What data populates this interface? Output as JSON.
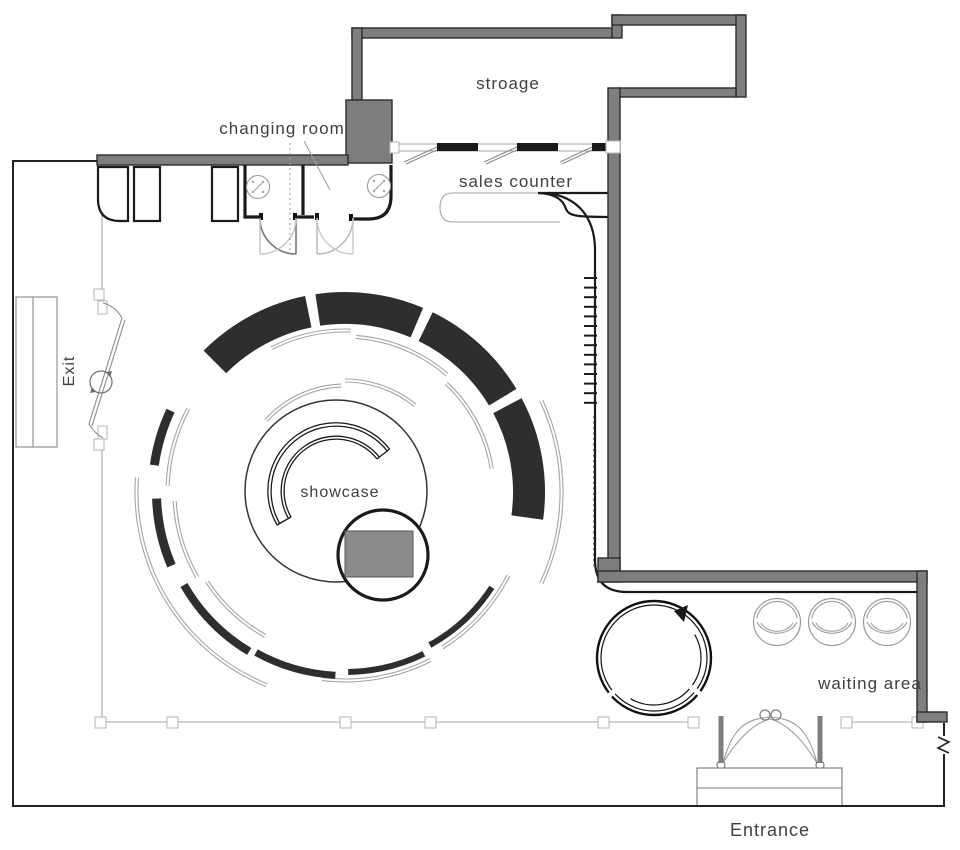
{
  "title": "boutique retail store floor plan",
  "labels": {
    "storage": "stroage",
    "changing_room": "changing room",
    "sales_counter": "sales counter",
    "showcase": "showcase",
    "waiting_area": "waiting area",
    "exit": "Exit",
    "entrance": "Entrance"
  },
  "colors": {
    "wall_fill": "#7e7e7e",
    "wall_stroke": "#2d2d2d",
    "fixture_dark": "#2e2e2e",
    "line_light": "#a5a5a5",
    "line_dark": "#1a1a1a",
    "showcase_block_fill": "#8b8b8b",
    "text": "#3f3f3f"
  }
}
